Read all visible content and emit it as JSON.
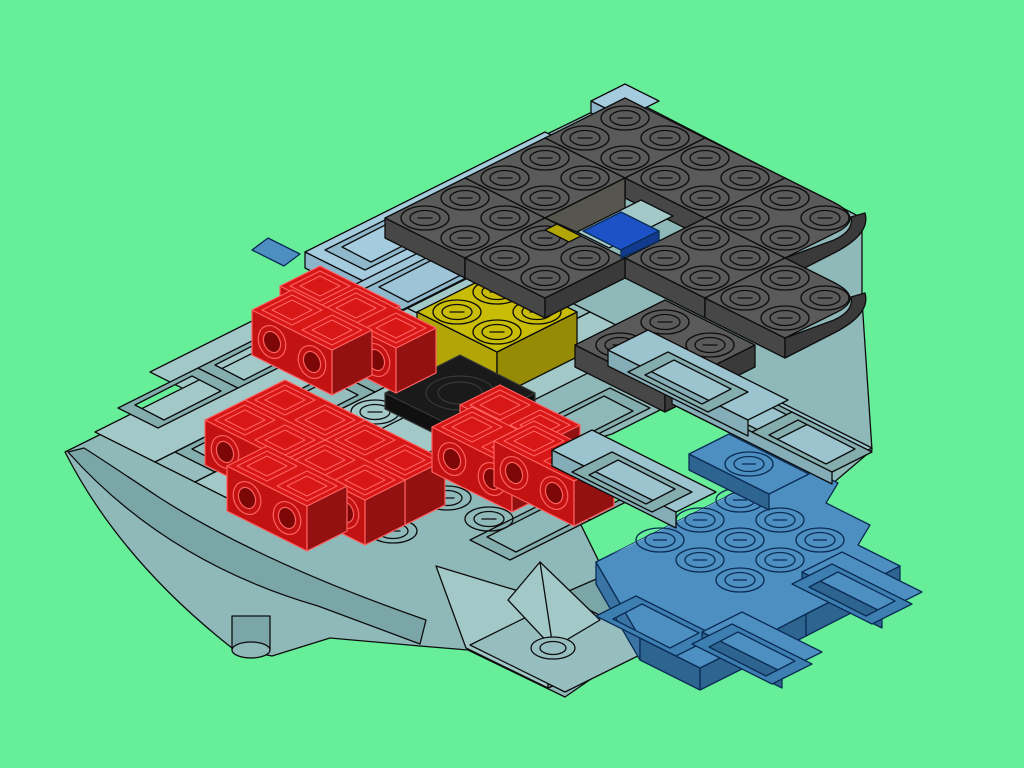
{
  "title": "Isometric render of a partially built LEGO model on a green background",
  "background": "#66EE99",
  "colors": {
    "bg": "#66EE99",
    "ink": "#0D0D0D",
    "tealBase": "#8FB8B8",
    "tealTop": "#A2C8C8",
    "tealTop2": "#96BEBE",
    "tealSide": "#7BA6A8",
    "tealDark": "#6E9A9A",
    "tealRing": "#84ADAD",
    "tealExt": "#9BC4CE",
    "tealExtSide": "#85ADB8",
    "lbTop": "#A5CBDF",
    "lbTop2": "#9EC4D8",
    "lbSide": "#8CB4CA",
    "lbRing": "#8FB8CC",
    "dkTop": "#5A5A5A",
    "dkSW": "#474747",
    "dkSE": "#3A3A3A",
    "dkWall": "#56564F",
    "dkHole": "#3F3F3F",
    "red": "#D81717",
    "redSW": "#C21212",
    "redSE": "#941111",
    "redLine": "#FF6060",
    "redHole": "#7C0707",
    "yel": "#C9BC07",
    "yelSW": "#B2A606",
    "yelSE": "#958B05",
    "blk": "#1A1A1A",
    "blkSide": "#101010",
    "blkLine": "#383838",
    "blu": "#4E8FC2",
    "bluLight": "#7FB2D6",
    "bluSide": "#2E6490",
    "bluSideL": "#3A74A4",
    "bluRing": "#3E7FB2",
    "bluLine": "#0A2C55",
    "brickBlue": "#1C52C6",
    "brickBlueSide": "#123A8E"
  },
  "scene": {
    "parts": [
      {
        "name": "teal-winged-baseplate",
        "color": "#8FB8B8"
      },
      {
        "name": "rear-light-blue-plates",
        "color": "#A5CBDF"
      },
      {
        "name": "dark-gray-plate-canopy",
        "color": "#5A5A5A"
      },
      {
        "name": "red-technic-bricks",
        "color": "#D81717"
      },
      {
        "name": "yellow-brick",
        "color": "#C9BC07"
      },
      {
        "name": "black-round-tile",
        "color": "#1A1A1A"
      },
      {
        "name": "blue-brick-in-hole",
        "color": "#1C52C6"
      },
      {
        "name": "blue-wing-plate",
        "color": "#4E8FC2"
      }
    ]
  }
}
